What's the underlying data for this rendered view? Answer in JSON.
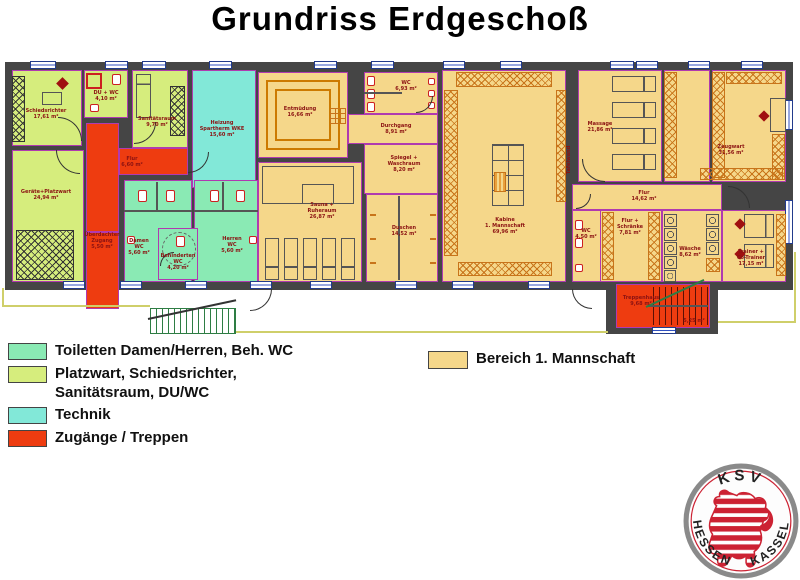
{
  "title": "Grundriss Erdgeschoß",
  "legend": {
    "items": [
      {
        "id": "wc",
        "color": "#8aeab4",
        "label": "Toiletten Damen/Herren, Beh. WC"
      },
      {
        "id": "service",
        "color": "#d6ed7d",
        "label": "Platzwart, Schiedsrichter,",
        "label2": "Sanitätsraum, DU/WC"
      },
      {
        "id": "technik",
        "color": "#82e8d8",
        "label": "Technik"
      },
      {
        "id": "access",
        "color": "#ee3c10",
        "label": "Zugänge / Treppen"
      }
    ],
    "team": {
      "color": "#f5d78a",
      "label": "Bereich 1. Mannschaft"
    }
  },
  "plan": {
    "rooms": [
      {
        "id": "schiedsrichter",
        "type": "service",
        "lines": [
          "Schiedsrichter",
          "17,61 m²"
        ]
      },
      {
        "id": "du_wc",
        "type": "service",
        "lines": [
          "DU + WC",
          "4,10 m²"
        ]
      },
      {
        "id": "sanitaetsraum",
        "type": "service",
        "lines": [
          "Sanitätsraum",
          "9,70 m²"
        ]
      },
      {
        "id": "heizung",
        "type": "technik",
        "lines": [
          "Heizung",
          "Spartherm WKE",
          "15,60 m²"
        ]
      },
      {
        "id": "geraete",
        "type": "service",
        "lines": [
          "Geräte+Platzwart",
          "24,94 m²"
        ]
      },
      {
        "id": "flur_links",
        "type": "access",
        "lines": [
          "Flur",
          "6,60 m²"
        ]
      },
      {
        "id": "zugang",
        "type": "access",
        "lines": [
          "Überdachter",
          "Zugang",
          "5,50 m²"
        ]
      },
      {
        "id": "damen_wc",
        "type": "wc",
        "lines": [
          "Damen",
          "WC",
          "5,60 m²"
        ]
      },
      {
        "id": "herren_wc",
        "type": "wc",
        "lines": [
          "Herren",
          "WC",
          "5,60 m²"
        ]
      },
      {
        "id": "beh_wc",
        "type": "wc",
        "lines": [
          "Behinderten",
          "WC",
          "4,20 m²"
        ]
      },
      {
        "id": "entmuedung",
        "type": "team",
        "lines": [
          "Entmüdung",
          "16,66 m²"
        ]
      },
      {
        "id": "wc_mitte",
        "type": "team",
        "lines": [
          "WC",
          "6,93 m²"
        ]
      },
      {
        "id": "durchgang",
        "type": "team",
        "lines": [
          "Durchgang",
          "8,91 m²"
        ]
      },
      {
        "id": "spiegel",
        "type": "team",
        "lines": [
          "Spiegel +",
          "Waschraum",
          "8,20 m²"
        ]
      },
      {
        "id": "sauna",
        "type": "team",
        "lines": [
          "Sauna +",
          "Ruheraum",
          "26,87 m²"
        ]
      },
      {
        "id": "duschen",
        "type": "team",
        "lines": [
          "Duschen",
          "14,52 m²"
        ]
      },
      {
        "id": "kabine",
        "type": "team",
        "lines": [
          "Kabine",
          "1. Mannschaft",
          "69,96 m²"
        ]
      },
      {
        "id": "tafelwand",
        "type": "note",
        "lines": [
          "Tafelwand"
        ]
      },
      {
        "id": "massage",
        "type": "team",
        "lines": [
          "Massage",
          "21,86 m²"
        ]
      },
      {
        "id": "gang_zeug",
        "type": "team",
        "lines": []
      },
      {
        "id": "zeugwart",
        "type": "team",
        "lines": [
          "Zeugwart",
          "31,56 m²"
        ]
      },
      {
        "id": "flur_rechts",
        "type": "team",
        "lines": [
          "Flur",
          "14,62 m²"
        ]
      },
      {
        "id": "wc_rechts",
        "type": "team",
        "lines": [
          "WC",
          "4,50 m²"
        ]
      },
      {
        "id": "flur_schraenke",
        "type": "team",
        "lines": [
          "Flur +",
          "Schränke",
          "7,81 m²"
        ]
      },
      {
        "id": "waesche",
        "type": "team",
        "lines": [
          "Wäsche",
          "8,62 m²"
        ]
      },
      {
        "id": "trainer",
        "type": "team",
        "lines": [
          "Trainer +",
          "Co-Trainer",
          "17,15 m²"
        ]
      },
      {
        "id": "treppenhaus",
        "type": "access",
        "lines": [
          "Treppenhaus",
          "9,68 m²"
        ]
      },
      {
        "id": "treppe2",
        "type": "note",
        "lines": [
          "5,25 m²"
        ]
      }
    ]
  },
  "logo": {
    "top": "KSV",
    "left": "HESSEN",
    "right": "KASSEL"
  },
  "colors": {
    "wall": "#454545",
    "room_border": "#b03ab0",
    "label_text": "#8b1212",
    "team": "#f5d78a",
    "service": "#d6ed7d",
    "wc": "#8aeab4",
    "technik": "#82e8d8",
    "access": "#ee3c10",
    "locker": "#c8741a",
    "logo_red": "#cc2233",
    "site_line": "#cfcf6a"
  }
}
